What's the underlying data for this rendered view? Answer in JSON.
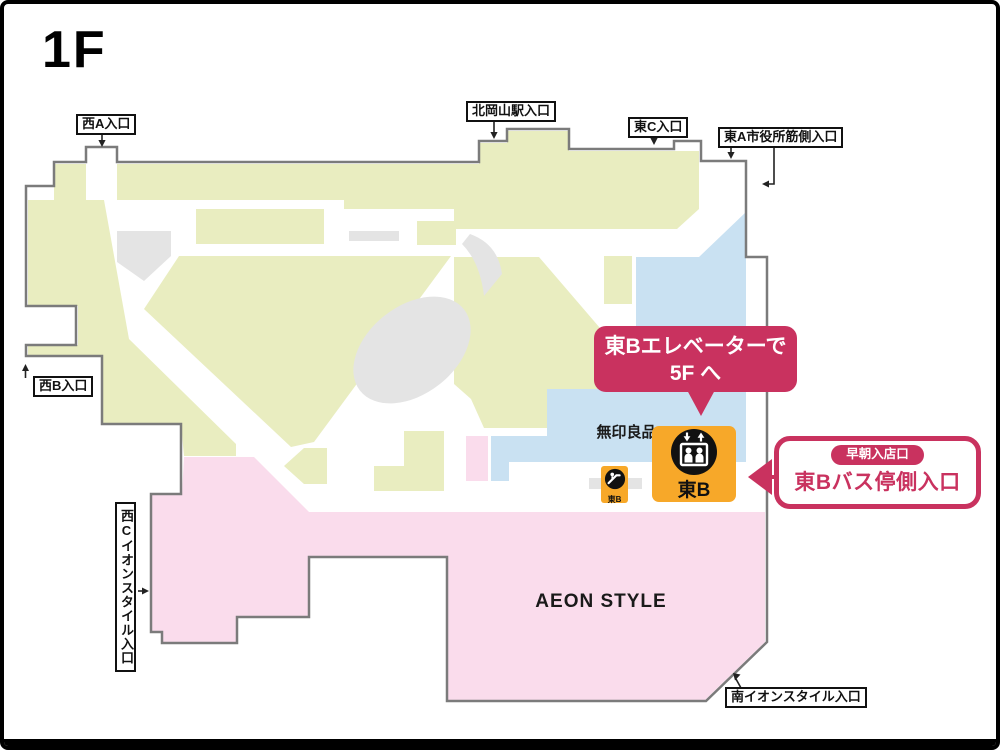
{
  "floor": {
    "label": "1F"
  },
  "colors": {
    "accent": "#c9325f",
    "orange": "#f7a829",
    "map-green": "#e9edc0",
    "map-gray": "#e4e4e4",
    "map-blue": "#c9e1f2",
    "map-pink": "#fadcec",
    "outline": "#7b7b7b"
  },
  "entrances": [
    {
      "id": "west-a",
      "label": "西A入口"
    },
    {
      "id": "kitaokayama-station",
      "label": "北岡山駅入口"
    },
    {
      "id": "east-c",
      "label": "東C入口"
    },
    {
      "id": "east-a-city-hall",
      "label": "東A市役所筋側入口"
    },
    {
      "id": "west-b",
      "label": "西B入口"
    },
    {
      "id": "west-c-aeon-style",
      "label": "西Cイオンスタイル入口"
    },
    {
      "id": "south-aeon-style",
      "label": "南イオンスタイル入口"
    }
  ],
  "stores": {
    "muji": "無印良品",
    "aeon_style": "AEON STYLE"
  },
  "bubble": {
    "line1": "東Bエレベーターで",
    "line2": "5F へ"
  },
  "callout": {
    "badge": "早朝入店口",
    "title": "東Bバス停側入口"
  },
  "elevator": {
    "label": "東B"
  },
  "escalator": {
    "label": "東B"
  }
}
